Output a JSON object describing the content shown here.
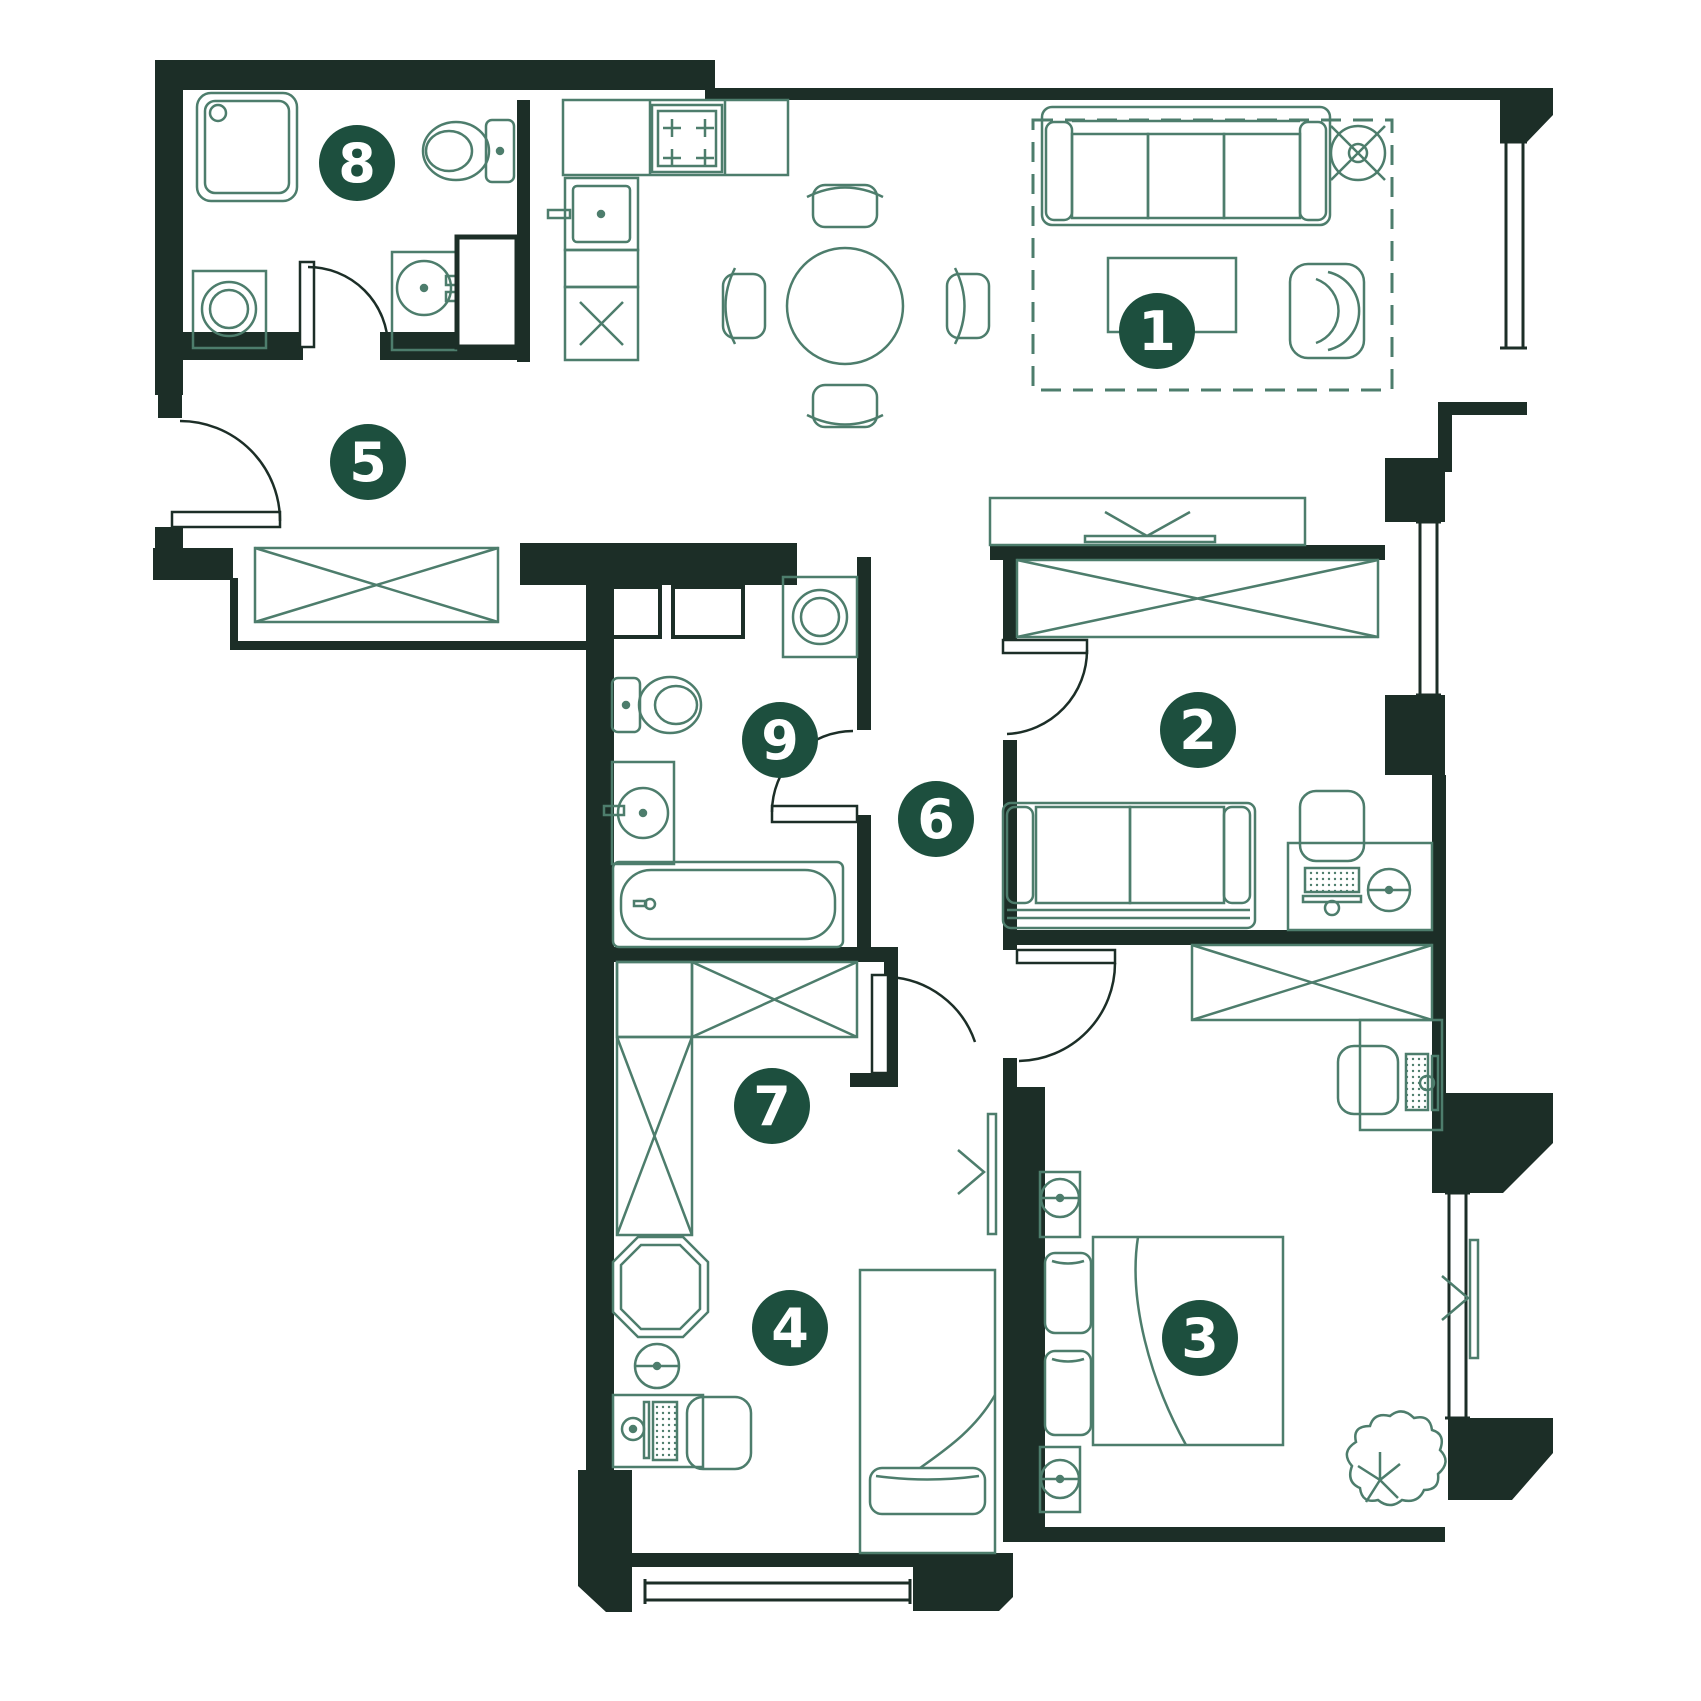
{
  "canvas": {
    "width": 1701,
    "height": 1701
  },
  "colors": {
    "background": "#ffffff",
    "wall": "#1c2e27",
    "furniture": "#4d7d6c",
    "marker_fill": "#1d4f3e",
    "marker_text": "#ffffff"
  },
  "markers": [
    {
      "name": "room-marker-1",
      "label": "1",
      "x": 1157,
      "y": 331
    },
    {
      "name": "room-marker-2",
      "label": "2",
      "x": 1198,
      "y": 730
    },
    {
      "name": "room-marker-3",
      "label": "3",
      "x": 1200,
      "y": 1338
    },
    {
      "name": "room-marker-4",
      "label": "4",
      "x": 790,
      "y": 1328
    },
    {
      "name": "room-marker-5",
      "label": "5",
      "x": 368,
      "y": 462
    },
    {
      "name": "room-marker-6",
      "label": "6",
      "x": 936,
      "y": 819
    },
    {
      "name": "room-marker-7",
      "label": "7",
      "x": 772,
      "y": 1106
    },
    {
      "name": "room-marker-8",
      "label": "8",
      "x": 357,
      "y": 163
    },
    {
      "name": "room-marker-9",
      "label": "9",
      "x": 780,
      "y": 740
    }
  ]
}
